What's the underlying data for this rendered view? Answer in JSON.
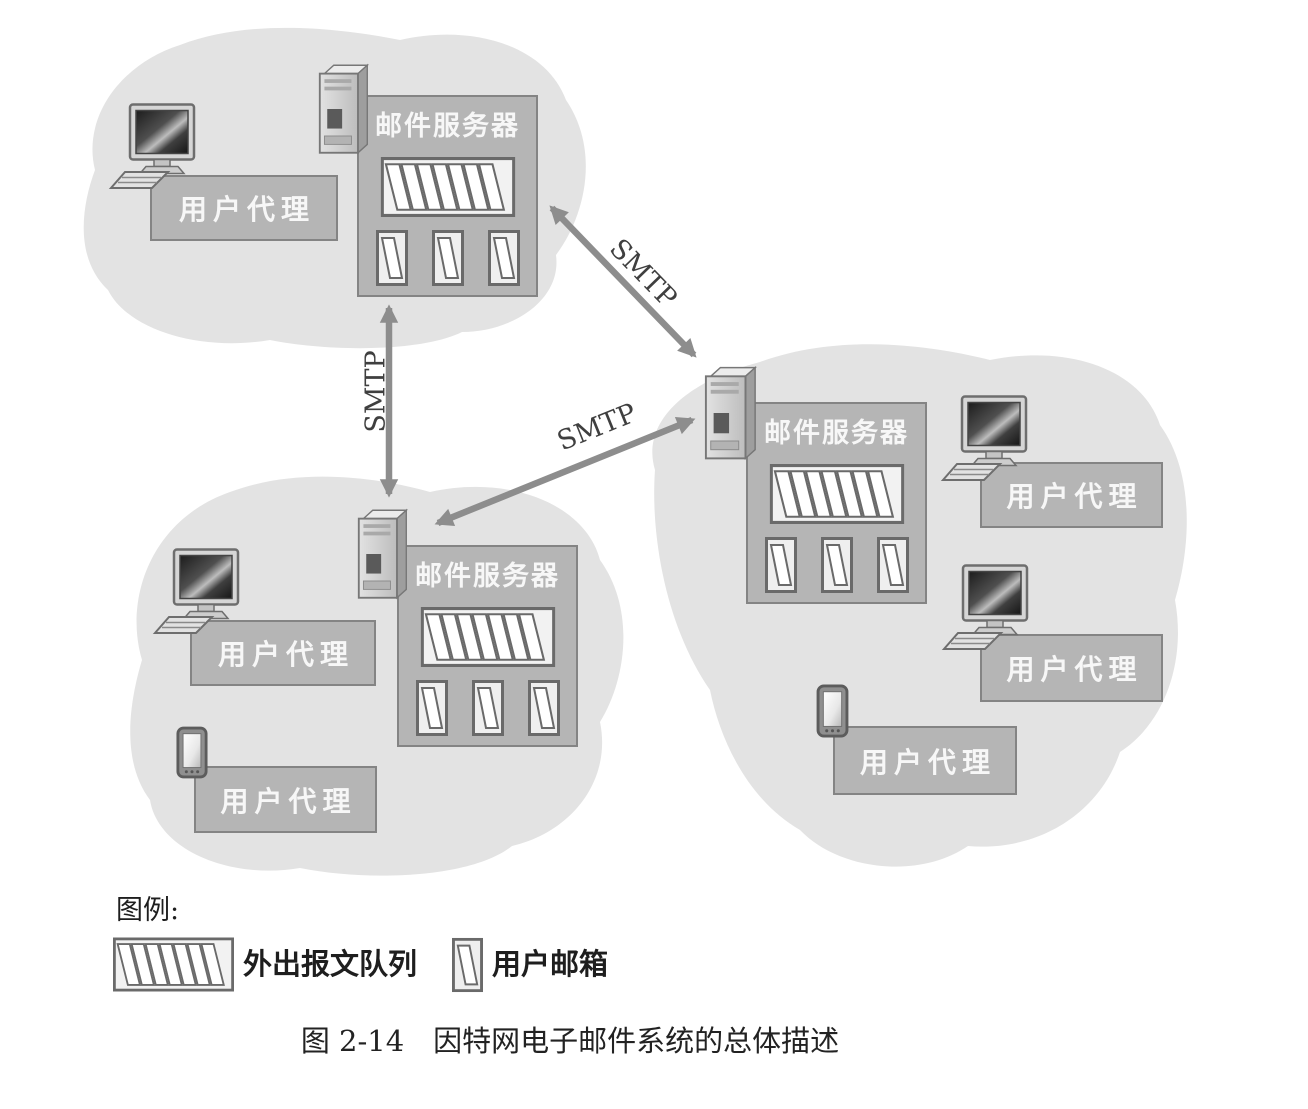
{
  "diagram": {
    "smtp_label": "SMTP",
    "mail_server_label": "邮件服务器",
    "user_agent_label": "用户代理"
  },
  "legend": {
    "title": "图例:",
    "items": [
      {
        "name": "outgoing-message-queue",
        "label": "外出报文队列"
      },
      {
        "name": "user-mailbox",
        "label": "用户邮箱"
      }
    ]
  },
  "caption": "图 2-14　因特网电子邮件系统的总体描述",
  "colors": {
    "cloud_fill": "#e3e3e3",
    "box_fill": "#b5b5b5",
    "box_border": "#848484",
    "arrow": "#8d8d8d",
    "box_label_text": "#f7f7f7",
    "dark_text": "#222222",
    "icon_page_fill": "#ffffff",
    "page_background": "#ffffff"
  }
}
